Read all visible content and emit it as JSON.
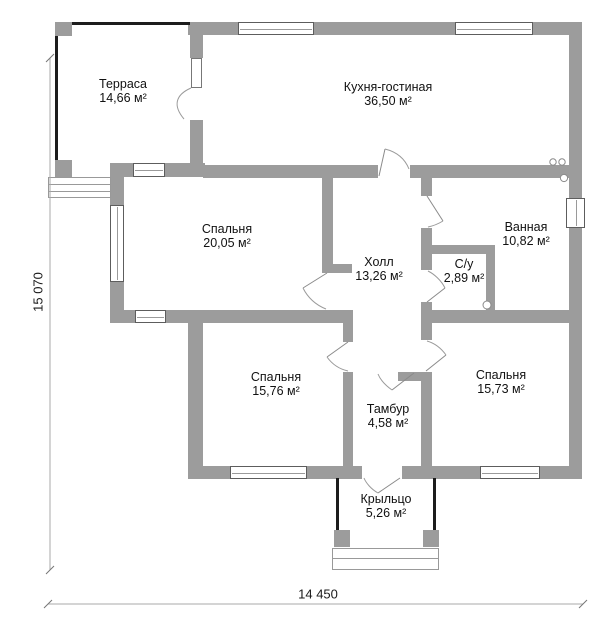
{
  "title": "floor-plan",
  "rooms": [
    {
      "id": "terrace",
      "name": "Терраса",
      "area": "14,66 м²"
    },
    {
      "id": "kitchen",
      "name": "Кухня-гостиная",
      "area": "36,50 м²"
    },
    {
      "id": "bedroom1",
      "name": "Спальня",
      "area": "20,05 м²"
    },
    {
      "id": "hall",
      "name": "Холл",
      "area": "13,26 м²"
    },
    {
      "id": "wc",
      "name": "С/у",
      "area": "2,89 м²"
    },
    {
      "id": "bathroom",
      "name": "Ванная",
      "area": "10,82 м²"
    },
    {
      "id": "bedroom2",
      "name": "Спальня",
      "area": "15,76 м²"
    },
    {
      "id": "tambour",
      "name": "Тамбур",
      "area": "4,58 м²"
    },
    {
      "id": "bedroom3",
      "name": "Спальня",
      "area": "15,73 м²"
    },
    {
      "id": "porch",
      "name": "Крыльцо",
      "area": "5,26 м²"
    }
  ],
  "dimensions": {
    "height_label": "15 070",
    "width_label": "14 450"
  },
  "colors": {
    "wall": "#9c9c9c",
    "line": "#8a8a8a"
  }
}
